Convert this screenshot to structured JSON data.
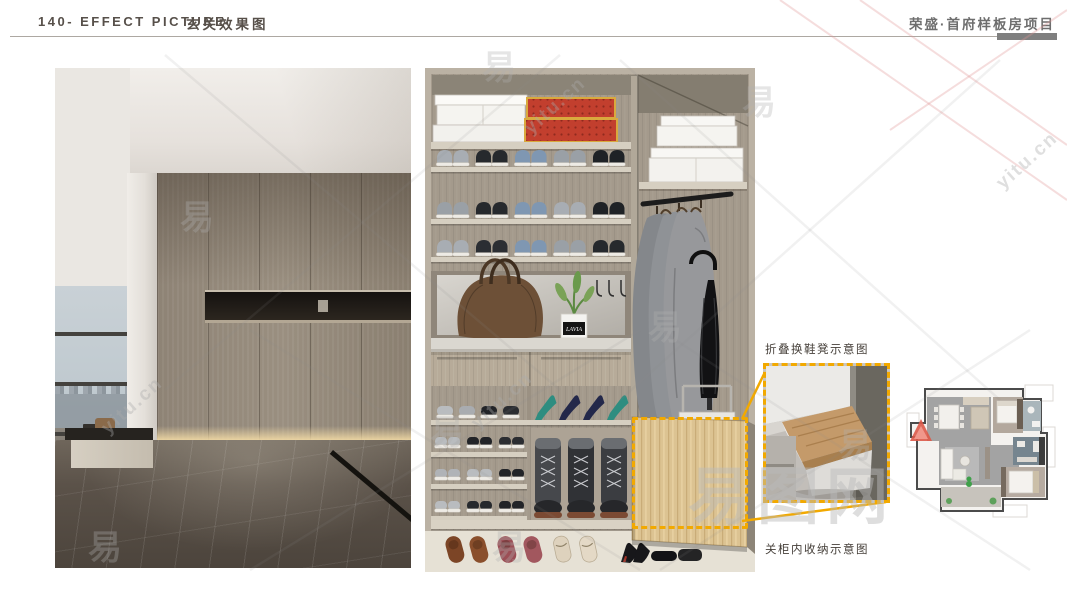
{
  "header": {
    "left_title_en": "140- EFFECT PICTURE",
    "left_title_cn": "玄关效果图",
    "project_title": "荣盛·首府样板房项目"
  },
  "callouts": {
    "stool": "折叠换鞋凳示意图",
    "storage": "关柜内收纳示意图"
  },
  "closet": {
    "plant_pot_label": "LAVIA"
  },
  "closet_items": {
    "sneaker_rows": [
      [
        "#a8adb3",
        "#26292d",
        "#7f97b2",
        "#9aa0a6",
        "#1f2226"
      ],
      [
        "#9aa0a6",
        "#26292d",
        "#7f97b2",
        "#a8adb3",
        "#1f2226"
      ],
      [
        "#a8adb3",
        "#2b2e33",
        "#7f97b2",
        "#9aa0a6",
        "#26292d"
      ]
    ],
    "slipper_row": [
      "#b9bcbf",
      "#a9acb0",
      "#222428",
      "#2b2d31"
    ],
    "heels": [
      "#2e8d80",
      "#23284a",
      "#23284a",
      "#2e8d80"
    ],
    "lower_rows": [
      [
        "#b9bcbf",
        "#222428",
        "#2b2d31"
      ],
      [
        "#b0b3b7",
        "#b9bcbf",
        "#222428"
      ],
      [
        "#b9bcbf",
        "#26292d",
        "#222428"
      ]
    ],
    "boots": [
      "#46484c",
      "#303236",
      "#3b3d41"
    ],
    "floor_row": [
      {
        "type": "slipper",
        "color": "#7c4526"
      },
      {
        "type": "slipper",
        "color": "#8a4f2c"
      },
      {
        "type": "slipper",
        "color": "#9c4f56"
      },
      {
        "type": "slipper",
        "color": "#a2575e"
      },
      {
        "type": "sandal",
        "color": "#ded2bd"
      },
      {
        "type": "sandal",
        "color": "#e4d9c6"
      },
      {
        "type": "heel",
        "color": "#17171a"
      },
      {
        "type": "flat",
        "color": "#131316"
      }
    ]
  },
  "watermarks": {
    "glyph": "易",
    "site": "yitu.cn",
    "brand": "易图网"
  },
  "colors": {
    "accent_yellow": "#F2A900",
    "header_text": "#57504A",
    "project_text": "#6E6E6E",
    "rule": "#ADA8A2",
    "rule_bar": "#7F7F7F",
    "entry_arrow_red": "#DD5948"
  }
}
